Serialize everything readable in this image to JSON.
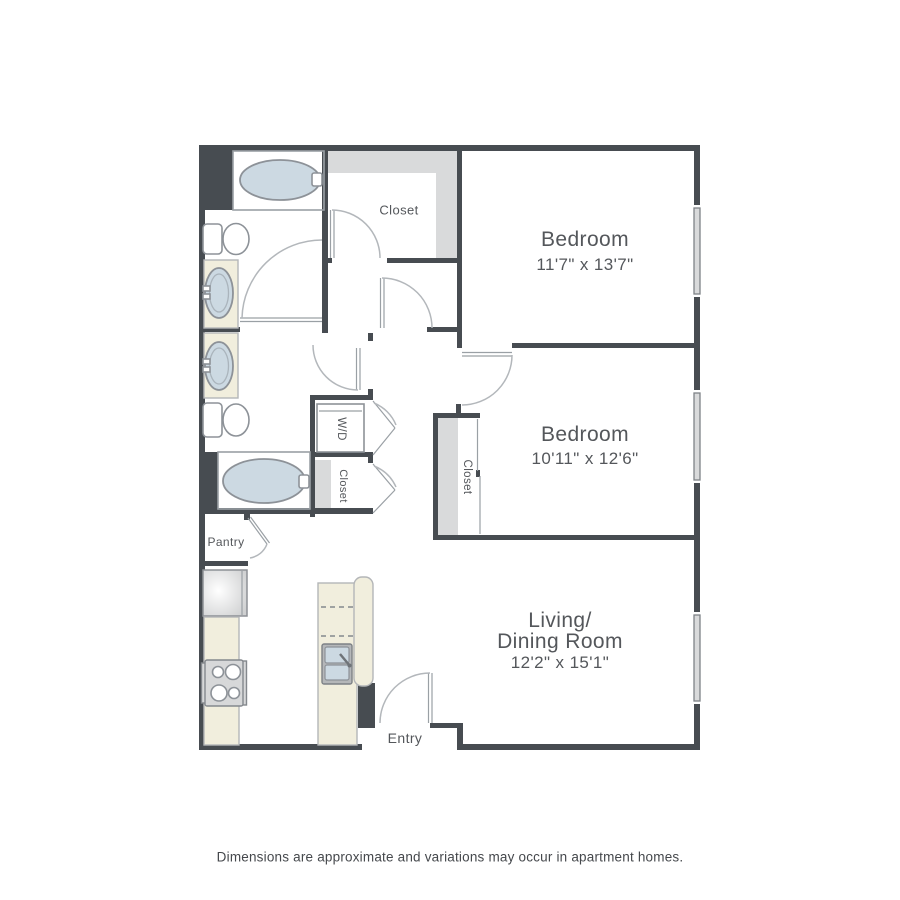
{
  "colors": {
    "wall": "#474c51",
    "line": "#9aa0a5",
    "arc": "#b3b7bb",
    "shelf": "#d9dadb",
    "cream": "#f1eedd",
    "tub": "#ccd9e2",
    "fixture": "#8d9298",
    "text": "#54575b",
    "footer_text": "#45484c",
    "steel": "#d7d8d9",
    "sash": "#7e8287"
  },
  "rooms": {
    "bedroom1": {
      "name": "Bedroom",
      "dims": "11'7\" x 13'7\""
    },
    "bedroom2": {
      "name": "Bedroom",
      "dims": "10'11\" x 12'6\""
    },
    "living": {
      "line1": "Living/",
      "line2": "Dining Room",
      "dims": "12'2\" x 15'1\""
    }
  },
  "labels": {
    "closet_main": "Closet",
    "closet_hall": "Closet",
    "closet_bed2": "Closet",
    "washer_dryer": "W/D",
    "pantry": "Pantry",
    "entry": "Entry"
  },
  "footer": {
    "disclaimer": "Dimensions are approximate and variations may occur in apartment homes."
  }
}
